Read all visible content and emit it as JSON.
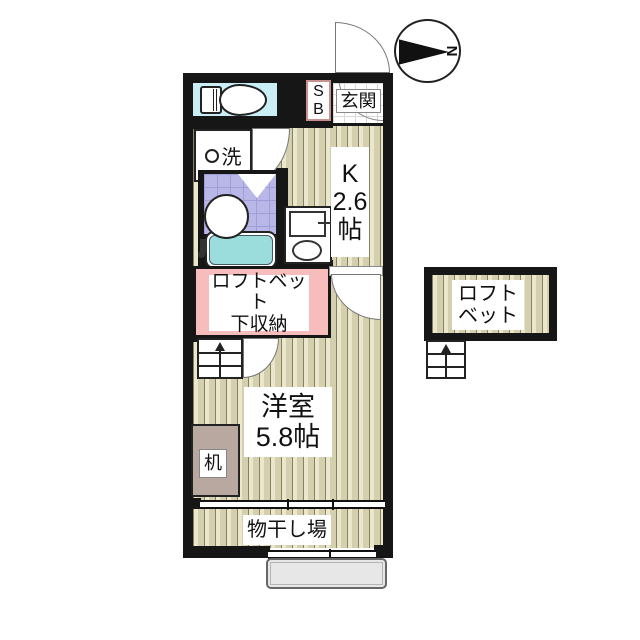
{
  "compass": {
    "north_label": "N"
  },
  "plan": {
    "entrance": {
      "label": "玄関",
      "shoe_box_line1": "S",
      "shoe_box_line2": "B"
    },
    "washer": {
      "label": "洗"
    },
    "kitchen": {
      "line1": "K",
      "line2": "2.6",
      "line3": "帖"
    },
    "storage": {
      "line1": "ロフトベット",
      "line2": "下収納"
    },
    "main_room": {
      "line1": "洋室",
      "line2": "5.8帖"
    },
    "desk": {
      "label": "机"
    },
    "drying": {
      "label": "物干し場"
    },
    "loft": {
      "line1": "ロフト",
      "line2": "ベット"
    }
  },
  "colors": {
    "wall": "#161616",
    "floor-line": "#86825f",
    "floor-light": "#ebe7cd",
    "floor-mid": "#d4cfae",
    "toilet-cyan": "#c9eef5",
    "bath-tile": "#b9b7e7",
    "bath-tile-line": "#a09ed6",
    "tub-cyan": "#9bdcdd",
    "storage-pink": "#f7bdbd",
    "desk-brown": "#b9a8a0",
    "step-gray": "#e7e7e7",
    "sb-border": "#c99090",
    "tile-line": "#d9d9d9",
    "door-line": "#777777"
  }
}
